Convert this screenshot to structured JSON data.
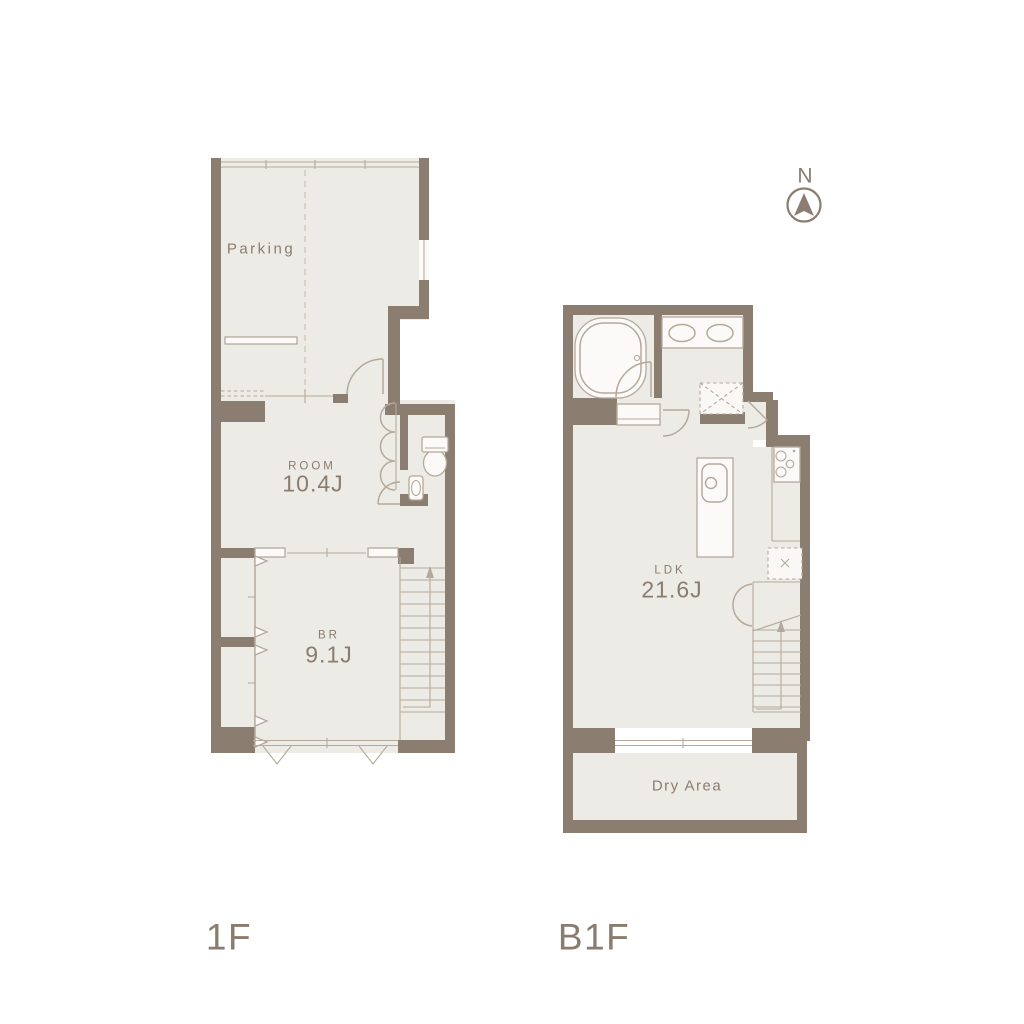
{
  "colors": {
    "bg": "#ffffff",
    "wall": "#8b7d70",
    "line": "#b5a99b",
    "room": "#edebe6",
    "text": "#8a7c6e",
    "dash": "#cdc4b7"
  },
  "compass": {
    "label": "N",
    "icon": "north-arrow-icon"
  },
  "floors": [
    {
      "id": "1F",
      "label": "1F",
      "rooms": [
        {
          "id": "parking",
          "label": "Parking"
        },
        {
          "id": "room",
          "label": "ROOM",
          "size": "10.4J"
        },
        {
          "id": "bedroom",
          "label": "BR",
          "size": "9.1J"
        }
      ]
    },
    {
      "id": "B1F",
      "label": "B1F",
      "rooms": [
        {
          "id": "ldk",
          "label": "LDK",
          "size": "21.6J"
        },
        {
          "id": "dry_area",
          "label": "Dry Area"
        }
      ]
    }
  ]
}
